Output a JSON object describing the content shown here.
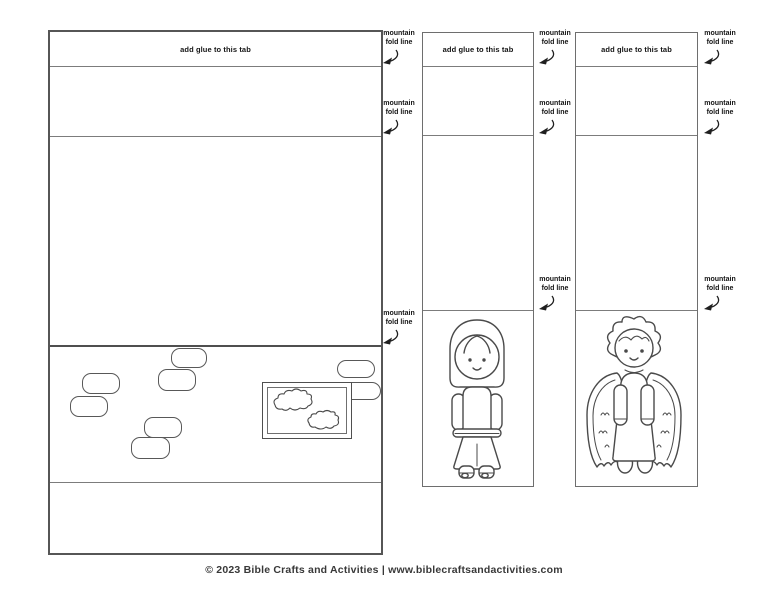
{
  "page": {
    "background": "#ffffff",
    "footer_text": "© 2023 Bible Crafts and Activities | www.biblecraftsandactivities.com"
  },
  "labels": {
    "glue_tab": "add glue to this tab",
    "fold_word_1": "mountain",
    "fold_word_2": "fold line"
  },
  "figures": {
    "left_scene": "stone-wall-with-framed-cloud-window",
    "middle_character": "mary-figure",
    "right_character": "angel-figure"
  },
  "icons": {
    "fold_arrow": "curved-arrow-down-left",
    "cloud": "cloud-shape"
  },
  "colors": {
    "panel_border": "#565656",
    "fold_line": "#7c7c7c",
    "figure_stroke": "#4a4a4a",
    "label_text": "#141414",
    "footer_text": "#383838",
    "background": "#ffffff"
  }
}
